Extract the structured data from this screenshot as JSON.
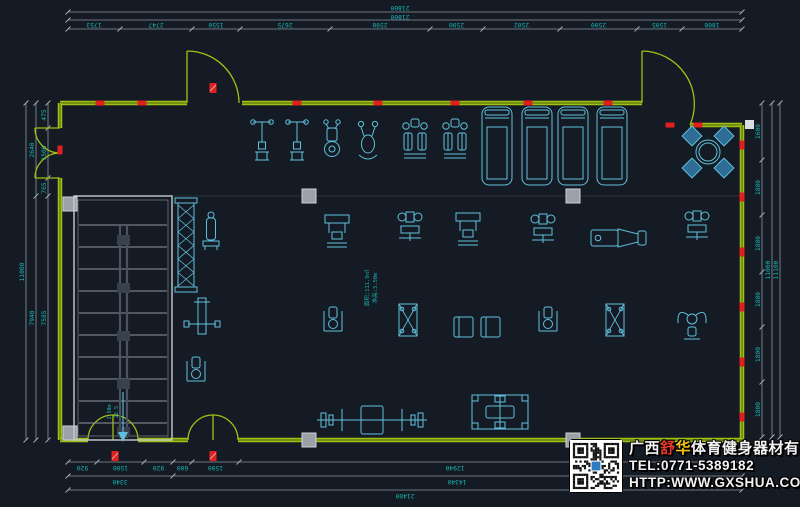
{
  "canvas": {
    "width": 800,
    "height": 507,
    "background": "#151b24"
  },
  "colors": {
    "wall": "#9fc016",
    "wall_core": "#5d7409",
    "dim_line": "#8f969e",
    "dim_text": "#17b3b3",
    "equipment": "#5fc1dd",
    "chair_fill": "#2e6e96",
    "red": "#e21f1f",
    "column": "#9aa2a8",
    "stair": "#c8ccd2"
  },
  "dimensions": {
    "top_overall": {
      "labels": [
        "21800",
        "21800"
      ]
    },
    "top_segments": [
      "1753",
      "2747",
      "1550",
      "2675",
      "2590",
      "2590",
      "2502",
      "2500",
      "1505",
      "1800"
    ],
    "left": {
      "overall": "11000",
      "col2": [
        "2640",
        "7940"
      ],
      "col3": [
        "475",
        "1500",
        "765",
        "7585"
      ]
    },
    "right": {
      "segments": [
        "1600",
        "1800",
        "1800",
        "1800",
        "1800",
        "1800"
      ],
      "overall": [
        "11000",
        "11100"
      ]
    },
    "bottom": {
      "segments": [
        "920",
        "1500",
        "920",
        "600",
        "1500",
        "12940"
      ],
      "row2": [
        "3340",
        "14340"
      ],
      "overall": "21400"
    }
  },
  "annotations": {
    "center": [
      "面积:111.9㎡",
      "净高:3.50m"
    ],
    "stair": [
      "2.50m",
      "22.5"
    ]
  },
  "company": {
    "name_p1": "广西",
    "name_red": "舒",
    "name_yellow": "华",
    "name_p2": "体育健身器材有限公司",
    "tel": "TEL:0771-5389182",
    "web": "HTTP:WWW.GXSHUA.COM"
  },
  "equipment": [
    {
      "type": "spin-bike",
      "x": 262,
      "y": 140
    },
    {
      "type": "spin-bike",
      "x": 297,
      "y": 140
    },
    {
      "type": "exercise-bike",
      "x": 332,
      "y": 139
    },
    {
      "type": "elliptical",
      "x": 368,
      "y": 141
    },
    {
      "type": "climber",
      "x": 415,
      "y": 142
    },
    {
      "type": "climber",
      "x": 455,
      "y": 142
    },
    {
      "type": "treadmill",
      "x": 497,
      "y": 146
    },
    {
      "type": "treadmill",
      "x": 537,
      "y": 146
    },
    {
      "type": "treadmill",
      "x": 573,
      "y": 146
    },
    {
      "type": "treadmill",
      "x": 612,
      "y": 146
    },
    {
      "type": "table-set",
      "x": 708,
      "y": 152
    },
    {
      "type": "dumbbell-rack",
      "x": 186,
      "y": 245
    },
    {
      "type": "plate-rack",
      "x": 211,
      "y": 233
    },
    {
      "type": "bench-press",
      "x": 202,
      "y": 316,
      "rot": 90
    },
    {
      "type": "seated-machine",
      "x": 196,
      "y": 372
    },
    {
      "type": "lat-machine",
      "x": 337,
      "y": 232
    },
    {
      "type": "press-machine",
      "x": 410,
      "y": 229
    },
    {
      "type": "lat-machine",
      "x": 468,
      "y": 230
    },
    {
      "type": "press-machine",
      "x": 543,
      "y": 231
    },
    {
      "type": "leg-press",
      "x": 617,
      "y": 238
    },
    {
      "type": "press-machine",
      "x": 697,
      "y": 228
    },
    {
      "type": "seated-machine",
      "x": 333,
      "y": 322
    },
    {
      "type": "cable-frame",
      "x": 408,
      "y": 320
    },
    {
      "type": "dual-bench",
      "x": 477,
      "y": 327
    },
    {
      "type": "seated-machine",
      "x": 548,
      "y": 322
    },
    {
      "type": "cable-frame",
      "x": 615,
      "y": 320
    },
    {
      "type": "pec-fly",
      "x": 692,
      "y": 322
    },
    {
      "type": "olympic-bench",
      "x": 372,
      "y": 420
    },
    {
      "type": "power-rack",
      "x": 500,
      "y": 412
    }
  ]
}
